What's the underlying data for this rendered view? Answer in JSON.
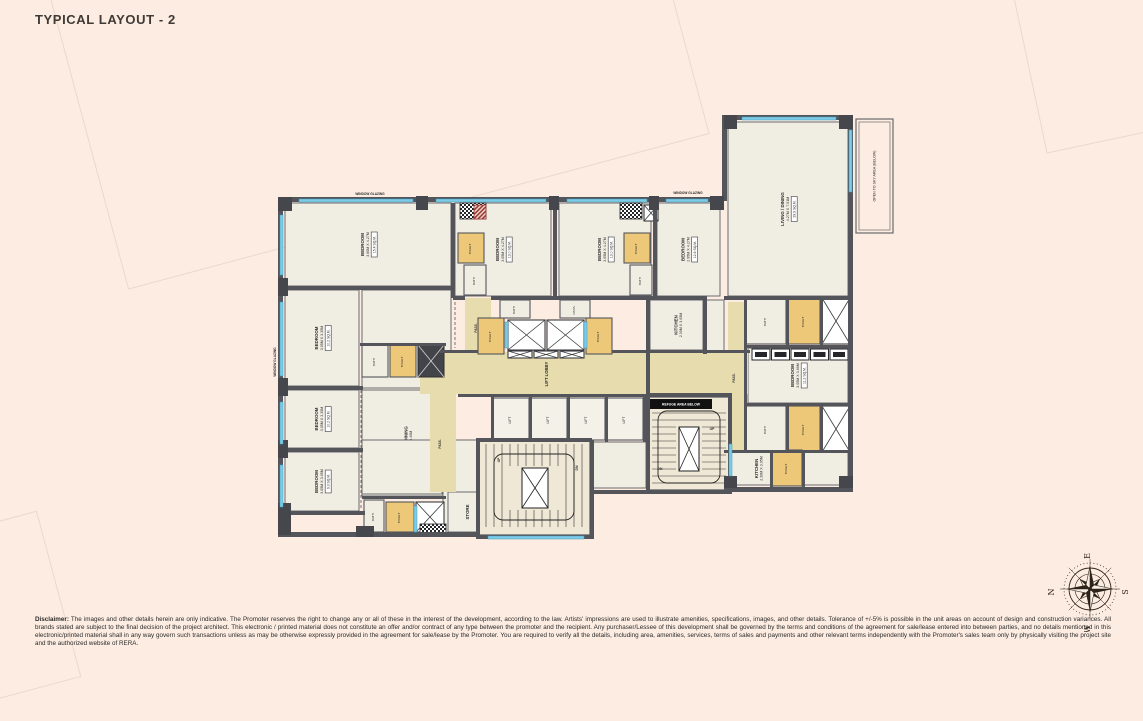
{
  "title": "TYPICAL LAYOUT - 2",
  "colors": {
    "background": "#fcece1",
    "wall": "#54555a",
    "room": "#f0ede3",
    "corridor": "#e7dcae",
    "toilet": "#ecc878",
    "window": "#7ecbe6",
    "stair": "#efe8d6",
    "accent_red": "#a03a34",
    "text": "#2e2e2e"
  },
  "compass": {
    "top": "E",
    "left": "N",
    "right": "S",
    "bottom": "W"
  },
  "disclaimer": {
    "label": "Disclaimer:",
    "text": " The images and other details herein are only indicative. The Promoter reserves the right to change any or all of these in the interest of the development, according to the law. Artists' impressions are used to illustrate amenities, specifications, images, and other details. Tolerance of +/-5% is possible in the unit areas on account of design and construction variances. All brands stated are subject to the final decision of the project architect. This electronic / printed material does not constitute an offer and/or contract of any type between the promoter and the recipient. Any purchaser/Lessee of this development shall be governed by the terms and conditions of the agreement for sale/lease entered into between parties, and no details mentioned in this electronic/printed material shall in any way govern such transactions unless as may be otherwise expressly provided in the agreement for sale/lease by the Promoter. You are required to verify all the details, including area, amenities, services, terms of sales and payments and other relevant terms independently with the Promoter's sales team only by physically visiting the project site and the authorized website of RERA."
  },
  "plan": {
    "annotation": "OPEN TO SKY AREA (BELOW)",
    "refuge_band": "REFUGE AREA BELOW",
    "elements": [
      {
        "t": "room",
        "x": 285,
        "y": 203,
        "w": 166,
        "h": 83,
        "n": "BEDROOM",
        "d": "3.60M X 4.27M",
        "a": "15.4 SQ.M."
      },
      {
        "t": "room",
        "x": 285,
        "y": 290,
        "w": 74,
        "h": 96,
        "n": "BEDROOM",
        "d": "3.05M X 3.35M",
        "a": "10.2 SQ.M."
      },
      {
        "t": "room",
        "x": 285,
        "y": 390,
        "w": 74,
        "h": 58,
        "n": "BEDROOM",
        "d": "3.05M X 3.35M",
        "a": "10.2 SQ.M."
      },
      {
        "t": "room",
        "x": 285,
        "y": 452,
        "w": 74,
        "h": 59,
        "n": "BEDROOM",
        "d": "3.05M X 3.05M",
        "a": "9.3 SQ.M."
      },
      {
        "t": "plain",
        "x": 362,
        "y": 290,
        "w": 89,
        "h": 98
      },
      {
        "t": "room",
        "x": 362,
        "y": 390,
        "w": 89,
        "h": 106,
        "n": "LIVING / DINING",
        "d": "3.66M X 6.40M"
      },
      {
        "t": "room",
        "x": 455,
        "y": 203,
        "w": 96,
        "h": 93,
        "n": "BEDROOM",
        "d": "3.05M X 4.27M",
        "a": "13.0 SQ.M."
      },
      {
        "t": "room",
        "x": 559,
        "y": 203,
        "w": 92,
        "h": 93,
        "n": "BEDROOM",
        "d": "3.05M X 4.27M",
        "a": "13.0 SQ.M."
      },
      {
        "t": "room",
        "x": 657,
        "y": 203,
        "w": 63,
        "h": 93,
        "n": "BEDROOM",
        "d": "2.95M X 4.27M",
        "a": "12.6 SQ.M."
      },
      {
        "t": "room",
        "x": 650,
        "y": 300,
        "w": 53,
        "h": 50,
        "n": "KITCHEN",
        "d": "2.30M X 3.05M"
      },
      {
        "t": "room",
        "x": 728,
        "y": 122,
        "w": 120,
        "h": 174,
        "n": "LIVING / DINING",
        "d": "4.27M X 7.01M",
        "a": "29.9 SQ.M."
      },
      {
        "t": "room",
        "x": 748,
        "y": 348,
        "w": 100,
        "h": 55,
        "n": "BEDROOM",
        "d": "3.05M X 3.66M",
        "a": "11.2 SQ.M."
      },
      {
        "t": "room",
        "x": 728,
        "y": 452,
        "w": 58,
        "h": 33,
        "n": "KITCHEN",
        "d": "2.30M X 3.05M"
      },
      {
        "t": "plain",
        "x": 592,
        "y": 442,
        "w": 54,
        "h": 46
      },
      {
        "t": "plain",
        "x": 362,
        "y": 440,
        "w": 80,
        "h": 54
      },
      {
        "t": "plain",
        "x": 443,
        "y": 440,
        "w": 35,
        "h": 94
      },
      {
        "t": "plain",
        "x": 705,
        "y": 300,
        "w": 19,
        "h": 52
      },
      {
        "t": "plain",
        "x": 804,
        "y": 452,
        "w": 44,
        "h": 33
      },
      {
        "t": "room",
        "x": 448,
        "y": 492,
        "w": 40,
        "h": 40,
        "n": "STORE",
        "d": ""
      },
      {
        "t": "tan",
        "x": 420,
        "y": 352,
        "w": 328,
        "h": 42
      },
      {
        "t": "tan",
        "x": 430,
        "y": 394,
        "w": 26,
        "h": 98
      },
      {
        "t": "tan",
        "x": 465,
        "y": 298,
        "w": 26,
        "h": 56
      },
      {
        "t": "tan",
        "x": 728,
        "y": 302,
        "w": 16,
        "h": 148
      },
      {
        "t": "stairsV",
        "x": 478,
        "y": 440,
        "w": 112,
        "h": 95
      },
      {
        "t": "stairsH",
        "x": 648,
        "y": 397,
        "w": 82,
        "h": 93
      },
      {
        "t": "toilet",
        "x": 390,
        "y": 345,
        "w": 26,
        "h": 32,
        "n": "TOILET"
      },
      {
        "t": "toilet",
        "x": 458,
        "y": 233,
        "w": 26,
        "h": 30,
        "n": "TOILET"
      },
      {
        "t": "toilet",
        "x": 624,
        "y": 233,
        "w": 26,
        "h": 30,
        "n": "TOILET"
      },
      {
        "t": "toilet",
        "x": 478,
        "y": 318,
        "w": 26,
        "h": 36,
        "n": "TOILET"
      },
      {
        "t": "toilet",
        "x": 586,
        "y": 318,
        "w": 26,
        "h": 36,
        "n": "TOILET"
      },
      {
        "t": "toilet",
        "x": 788,
        "y": 298,
        "w": 32,
        "h": 46,
        "n": "TOILET"
      },
      {
        "t": "toilet",
        "x": 788,
        "y": 406,
        "w": 32,
        "h": 46,
        "n": "TOILET"
      },
      {
        "t": "toilet",
        "x": 386,
        "y": 502,
        "w": 28,
        "h": 30,
        "n": "TOILET"
      },
      {
        "t": "toilet",
        "x": 772,
        "y": 450,
        "w": 30,
        "h": 36,
        "n": "TOILET"
      },
      {
        "t": "bath",
        "x": 362,
        "y": 345,
        "w": 26,
        "h": 32,
        "n": "BATH"
      },
      {
        "t": "bath",
        "x": 464,
        "y": 265,
        "w": 22,
        "h": 30,
        "n": "BATH"
      },
      {
        "t": "bath",
        "x": 630,
        "y": 265,
        "w": 22,
        "h": 30,
        "n": "BATH"
      },
      {
        "t": "bath",
        "x": 746,
        "y": 298,
        "w": 40,
        "h": 46,
        "n": "BATH"
      },
      {
        "t": "bath",
        "x": 746,
        "y": 406,
        "w": 40,
        "h": 46,
        "n": "BATH"
      },
      {
        "t": "bath",
        "x": 364,
        "y": 500,
        "w": 20,
        "h": 32,
        "n": "BATH"
      },
      {
        "t": "bath",
        "x": 500,
        "y": 300,
        "w": 30,
        "h": 18,
        "n": "BATH"
      },
      {
        "t": "bath",
        "x": 560,
        "y": 300,
        "w": 30,
        "h": 18,
        "n": "PASS."
      },
      {
        "t": "xbox",
        "x": 822,
        "y": 298,
        "w": 28,
        "h": 46
      },
      {
        "t": "xbox",
        "x": 822,
        "y": 406,
        "w": 28,
        "h": 46
      },
      {
        "t": "xbox",
        "x": 416,
        "y": 502,
        "w": 28,
        "h": 30
      },
      {
        "t": "xbox",
        "x": 644,
        "y": 205,
        "w": 14,
        "h": 16
      },
      {
        "t": "xbox",
        "x": 508,
        "y": 320,
        "w": 37,
        "h": 30
      },
      {
        "t": "xbox",
        "x": 547,
        "y": 320,
        "w": 37,
        "h": 30
      },
      {
        "t": "xbox",
        "x": 508,
        "y": 351,
        "w": 24,
        "h": 7
      },
      {
        "t": "xbox",
        "x": 534,
        "y": 351,
        "w": 24,
        "h": 7
      },
      {
        "t": "xbox",
        "x": 560,
        "y": 351,
        "w": 24,
        "h": 7
      },
      {
        "t": "dshaft",
        "x": 418,
        "y": 345,
        "w": 26,
        "h": 32
      },
      {
        "t": "checker",
        "x": 460,
        "y": 203,
        "w": 26,
        "h": 16
      },
      {
        "t": "checker",
        "x": 620,
        "y": 203,
        "w": 22,
        "h": 16
      },
      {
        "t": "checker",
        "x": 420,
        "y": 524,
        "w": 26,
        "h": 10
      },
      {
        "t": "red",
        "x": 474,
        "y": 205,
        "w": 12,
        "h": 14
      },
      {
        "t": "lift",
        "x": 493,
        "y": 398,
        "w": 36,
        "h": 42,
        "n": "LIFT"
      },
      {
        "t": "lift",
        "x": 531,
        "y": 398,
        "w": 36,
        "h": 42,
        "n": "LIFT"
      },
      {
        "t": "lift",
        "x": 569,
        "y": 398,
        "w": 36,
        "h": 42,
        "n": "LIFT"
      },
      {
        "t": "lift",
        "x": 607,
        "y": 398,
        "w": 36,
        "h": 42,
        "n": "LIFT"
      },
      {
        "t": "row5",
        "x": 752,
        "y": 349,
        "w": 96,
        "h": 11
      },
      {
        "t": "wall",
        "x": 283,
        "y": 197,
        "w": 441,
        "h": 5
      },
      {
        "t": "wall",
        "x": 722,
        "y": 115,
        "w": 131,
        "h": 5
      },
      {
        "t": "wall",
        "x": 722,
        "y": 115,
        "w": 5,
        "h": 86
      },
      {
        "t": "wall",
        "x": 278,
        "y": 197,
        "w": 5,
        "h": 340
      },
      {
        "t": "wall",
        "x": 278,
        "y": 532,
        "w": 202,
        "h": 5
      },
      {
        "t": "wall",
        "x": 476,
        "y": 535,
        "w": 118,
        "h": 4
      },
      {
        "t": "wall",
        "x": 476,
        "y": 438,
        "w": 4,
        "h": 100
      },
      {
        "t": "wall",
        "x": 590,
        "y": 440,
        "w": 4,
        "h": 98
      },
      {
        "t": "wall",
        "x": 590,
        "y": 490,
        "w": 60,
        "h": 4
      },
      {
        "t": "wall",
        "x": 646,
        "y": 490,
        "w": 86,
        "h": 4
      },
      {
        "t": "wall",
        "x": 724,
        "y": 487,
        "w": 129,
        "h": 5
      },
      {
        "t": "wall",
        "x": 848,
        "y": 115,
        "w": 5,
        "h": 377
      },
      {
        "t": "wall",
        "x": 451,
        "y": 203,
        "w": 4,
        "h": 95
      },
      {
        "t": "wall",
        "x": 281,
        "y": 286,
        "w": 172,
        "h": 4
      },
      {
        "t": "wall",
        "x": 281,
        "y": 386,
        "w": 82,
        "h": 4
      },
      {
        "t": "wall",
        "x": 281,
        "y": 448,
        "w": 82,
        "h": 4
      },
      {
        "t": "wall",
        "x": 281,
        "y": 511,
        "w": 84,
        "h": 4
      },
      {
        "t": "wall",
        "x": 553,
        "y": 203,
        "w": 4,
        "h": 95
      },
      {
        "t": "wall",
        "x": 653,
        "y": 203,
        "w": 4,
        "h": 95
      },
      {
        "t": "wall",
        "x": 453,
        "y": 296,
        "w": 12,
        "h": 4
      },
      {
        "t": "wall",
        "x": 491,
        "y": 296,
        "w": 216,
        "h": 4
      },
      {
        "t": "wall",
        "x": 703,
        "y": 296,
        "w": 4,
        "h": 58
      },
      {
        "t": "wall",
        "x": 646,
        "y": 296,
        "w": 4,
        "h": 100
      },
      {
        "t": "wall",
        "x": 724,
        "y": 296,
        "w": 129,
        "h": 4
      },
      {
        "t": "wall",
        "x": 744,
        "y": 296,
        "w": 3,
        "h": 156
      },
      {
        "t": "wall",
        "x": 786,
        "y": 296,
        "w": 3,
        "h": 49
      },
      {
        "t": "wall",
        "x": 820,
        "y": 296,
        "w": 3,
        "h": 49
      },
      {
        "t": "wall",
        "x": 744,
        "y": 345,
        "w": 106,
        "h": 3
      },
      {
        "t": "wall",
        "x": 744,
        "y": 403,
        "w": 106,
        "h": 3
      },
      {
        "t": "wall",
        "x": 786,
        "y": 403,
        "w": 3,
        "h": 49
      },
      {
        "t": "wall",
        "x": 820,
        "y": 403,
        "w": 3,
        "h": 49
      },
      {
        "t": "wall",
        "x": 724,
        "y": 450,
        "w": 129,
        "h": 3
      },
      {
        "t": "wall",
        "x": 770,
        "y": 450,
        "w": 3,
        "h": 37
      },
      {
        "t": "wall",
        "x": 802,
        "y": 450,
        "w": 3,
        "h": 37
      },
      {
        "t": "wall",
        "x": 440,
        "y": 350,
        "w": 38,
        "h": 3
      },
      {
        "t": "wall",
        "x": 612,
        "y": 350,
        "w": 138,
        "h": 3
      },
      {
        "t": "wall",
        "x": 458,
        "y": 394,
        "w": 190,
        "h": 3
      },
      {
        "t": "wall",
        "x": 491,
        "y": 396,
        "w": 3,
        "h": 46
      },
      {
        "t": "wall",
        "x": 529,
        "y": 396,
        "w": 3,
        "h": 46
      },
      {
        "t": "wall",
        "x": 567,
        "y": 396,
        "w": 3,
        "h": 46
      },
      {
        "t": "wall",
        "x": 605,
        "y": 396,
        "w": 3,
        "h": 46
      },
      {
        "t": "wall",
        "x": 643,
        "y": 396,
        "w": 3,
        "h": 46
      },
      {
        "t": "wall",
        "x": 478,
        "y": 438,
        "w": 114,
        "h": 4
      },
      {
        "t": "wall",
        "x": 646,
        "y": 393,
        "w": 86,
        "h": 4
      },
      {
        "t": "wall",
        "x": 646,
        "y": 393,
        "w": 4,
        "h": 100
      },
      {
        "t": "wall",
        "x": 728,
        "y": 393,
        "w": 4,
        "h": 97
      },
      {
        "t": "wall",
        "x": 360,
        "y": 343,
        "w": 86,
        "h": 3
      },
      {
        "t": "wall",
        "x": 362,
        "y": 496,
        "w": 84,
        "h": 3
      },
      {
        "t": "pier",
        "x": 278,
        "y": 197,
        "w": 14,
        "h": 14
      },
      {
        "t": "pier",
        "x": 416,
        "y": 196,
        "w": 12,
        "h": 14
      },
      {
        "t": "pier",
        "x": 549,
        "y": 196,
        "w": 10,
        "h": 14
      },
      {
        "t": "pier",
        "x": 649,
        "y": 196,
        "w": 10,
        "h": 14
      },
      {
        "t": "pier",
        "x": 710,
        "y": 196,
        "w": 14,
        "h": 14
      },
      {
        "t": "pier",
        "x": 278,
        "y": 278,
        "w": 10,
        "h": 18
      },
      {
        "t": "pier",
        "x": 278,
        "y": 378,
        "w": 10,
        "h": 18
      },
      {
        "t": "pier",
        "x": 278,
        "y": 440,
        "w": 10,
        "h": 18
      },
      {
        "t": "pier",
        "x": 278,
        "y": 503,
        "w": 13,
        "h": 32
      },
      {
        "t": "pier",
        "x": 356,
        "y": 526,
        "w": 18,
        "h": 11
      },
      {
        "t": "pier",
        "x": 724,
        "y": 115,
        "w": 13,
        "h": 14
      },
      {
        "t": "pier",
        "x": 839,
        "y": 115,
        "w": 14,
        "h": 14
      },
      {
        "t": "pier",
        "x": 839,
        "y": 476,
        "w": 14,
        "h": 12
      },
      {
        "t": "pier",
        "x": 724,
        "y": 476,
        "w": 13,
        "h": 12
      },
      {
        "t": "win",
        "x": 299,
        "y": 199,
        "w": 114,
        "h": 3
      },
      {
        "t": "win",
        "x": 436,
        "y": 199,
        "w": 110,
        "h": 3
      },
      {
        "t": "win",
        "x": 567,
        "y": 199,
        "w": 80,
        "h": 3
      },
      {
        "t": "win",
        "x": 666,
        "y": 199,
        "w": 42,
        "h": 3
      },
      {
        "t": "win",
        "x": 742,
        "y": 117,
        "w": 94,
        "h": 3
      },
      {
        "t": "win",
        "x": 280,
        "y": 215,
        "w": 3,
        "h": 60
      },
      {
        "t": "win",
        "x": 280,
        "y": 302,
        "w": 3,
        "h": 74
      },
      {
        "t": "win",
        "x": 280,
        "y": 402,
        "w": 3,
        "h": 42
      },
      {
        "t": "win",
        "x": 280,
        "y": 465,
        "w": 3,
        "h": 42
      },
      {
        "t": "win",
        "x": 849,
        "y": 130,
        "w": 3,
        "h": 62
      },
      {
        "t": "win",
        "x": 488,
        "y": 536,
        "w": 96,
        "h": 3
      },
      {
        "t": "win",
        "x": 729,
        "y": 444,
        "w": 3,
        "h": 32
      },
      {
        "t": "win",
        "x": 414,
        "y": 506,
        "w": 3,
        "h": 26
      },
      {
        "t": "win",
        "x": 505,
        "y": 322,
        "w": 3,
        "h": 26
      },
      {
        "t": "win",
        "x": 584,
        "y": 322,
        "w": 3,
        "h": 26
      },
      {
        "t": "dash",
        "x1": 361,
        "y1": 390,
        "x2": 361,
        "y2": 509
      },
      {
        "t": "dash",
        "x1": 455,
        "y1": 302,
        "x2": 455,
        "y2": 348
      },
      {
        "t": "band",
        "x": 650,
        "y": 399,
        "w": 62,
        "h": 10,
        "key": "refuge_band"
      },
      {
        "t": "abox",
        "x": 856,
        "y": 119,
        "w": 37,
        "h": 114,
        "key": "annotation"
      },
      {
        "t": "label",
        "x": 370,
        "y": 195,
        "s": 3.2,
        "r": 0,
        "n": "WINDOW GLAZING"
      },
      {
        "t": "label",
        "x": 688,
        "y": 194,
        "s": 3.2,
        "r": 0,
        "n": "WINDOW GLAZING"
      },
      {
        "t": "label",
        "x": 276,
        "y": 362,
        "s": 3.2,
        "r": -90,
        "n": "WINDOW GLAZING"
      },
      {
        "t": "label",
        "x": 548,
        "y": 374,
        "s": 4.2,
        "r": -90,
        "n": "LIFT LOBBY"
      },
      {
        "t": "label",
        "x": 477,
        "y": 328,
        "s": 3.2,
        "r": -90,
        "n": "PASS."
      },
      {
        "t": "label",
        "x": 441,
        "y": 444,
        "s": 3.2,
        "r": -90,
        "n": "PASS."
      },
      {
        "t": "label",
        "x": 735,
        "y": 378,
        "s": 3.2,
        "r": -90,
        "n": "PASS."
      },
      {
        "t": "label",
        "x": 500,
        "y": 460,
        "s": 3.4,
        "r": -90,
        "n": "UP"
      },
      {
        "t": "label",
        "x": 578,
        "y": 468,
        "s": 3.4,
        "r": -90,
        "n": "DN"
      },
      {
        "t": "label",
        "x": 712,
        "y": 430,
        "s": 3.4,
        "r": 0,
        "n": "UP"
      },
      {
        "t": "label",
        "x": 660,
        "y": 470,
        "s": 3.4,
        "r": 0,
        "n": "DN"
      }
    ]
  }
}
